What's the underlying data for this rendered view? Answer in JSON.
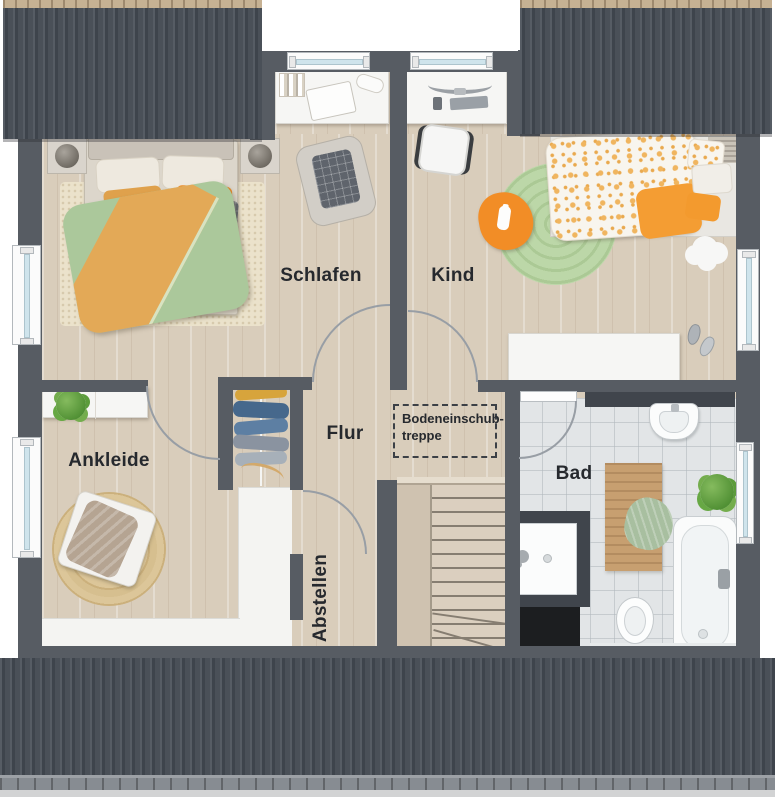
{
  "rooms": {
    "schlafen": {
      "label": "Schlafen"
    },
    "kind": {
      "label": "Kind"
    },
    "flur": {
      "label": "Flur"
    },
    "ankleide": {
      "label": "Ankleide"
    },
    "abstellen": {
      "label": "Abstellen"
    },
    "bad": {
      "label": "Bad"
    },
    "attic_hatch": {
      "line1": "Bodeneinschub-",
      "line2": "treppe"
    }
  },
  "colors": {
    "wall": "#575c63",
    "roof": "#4a5058",
    "roof_eave": "#c6b193",
    "floor_wood": "#d9cdbb",
    "floor_tile": "#e2e5e7",
    "accent_orange": "#ef9023",
    "accent_green": "#abc89b",
    "label_text": "#26292e"
  }
}
